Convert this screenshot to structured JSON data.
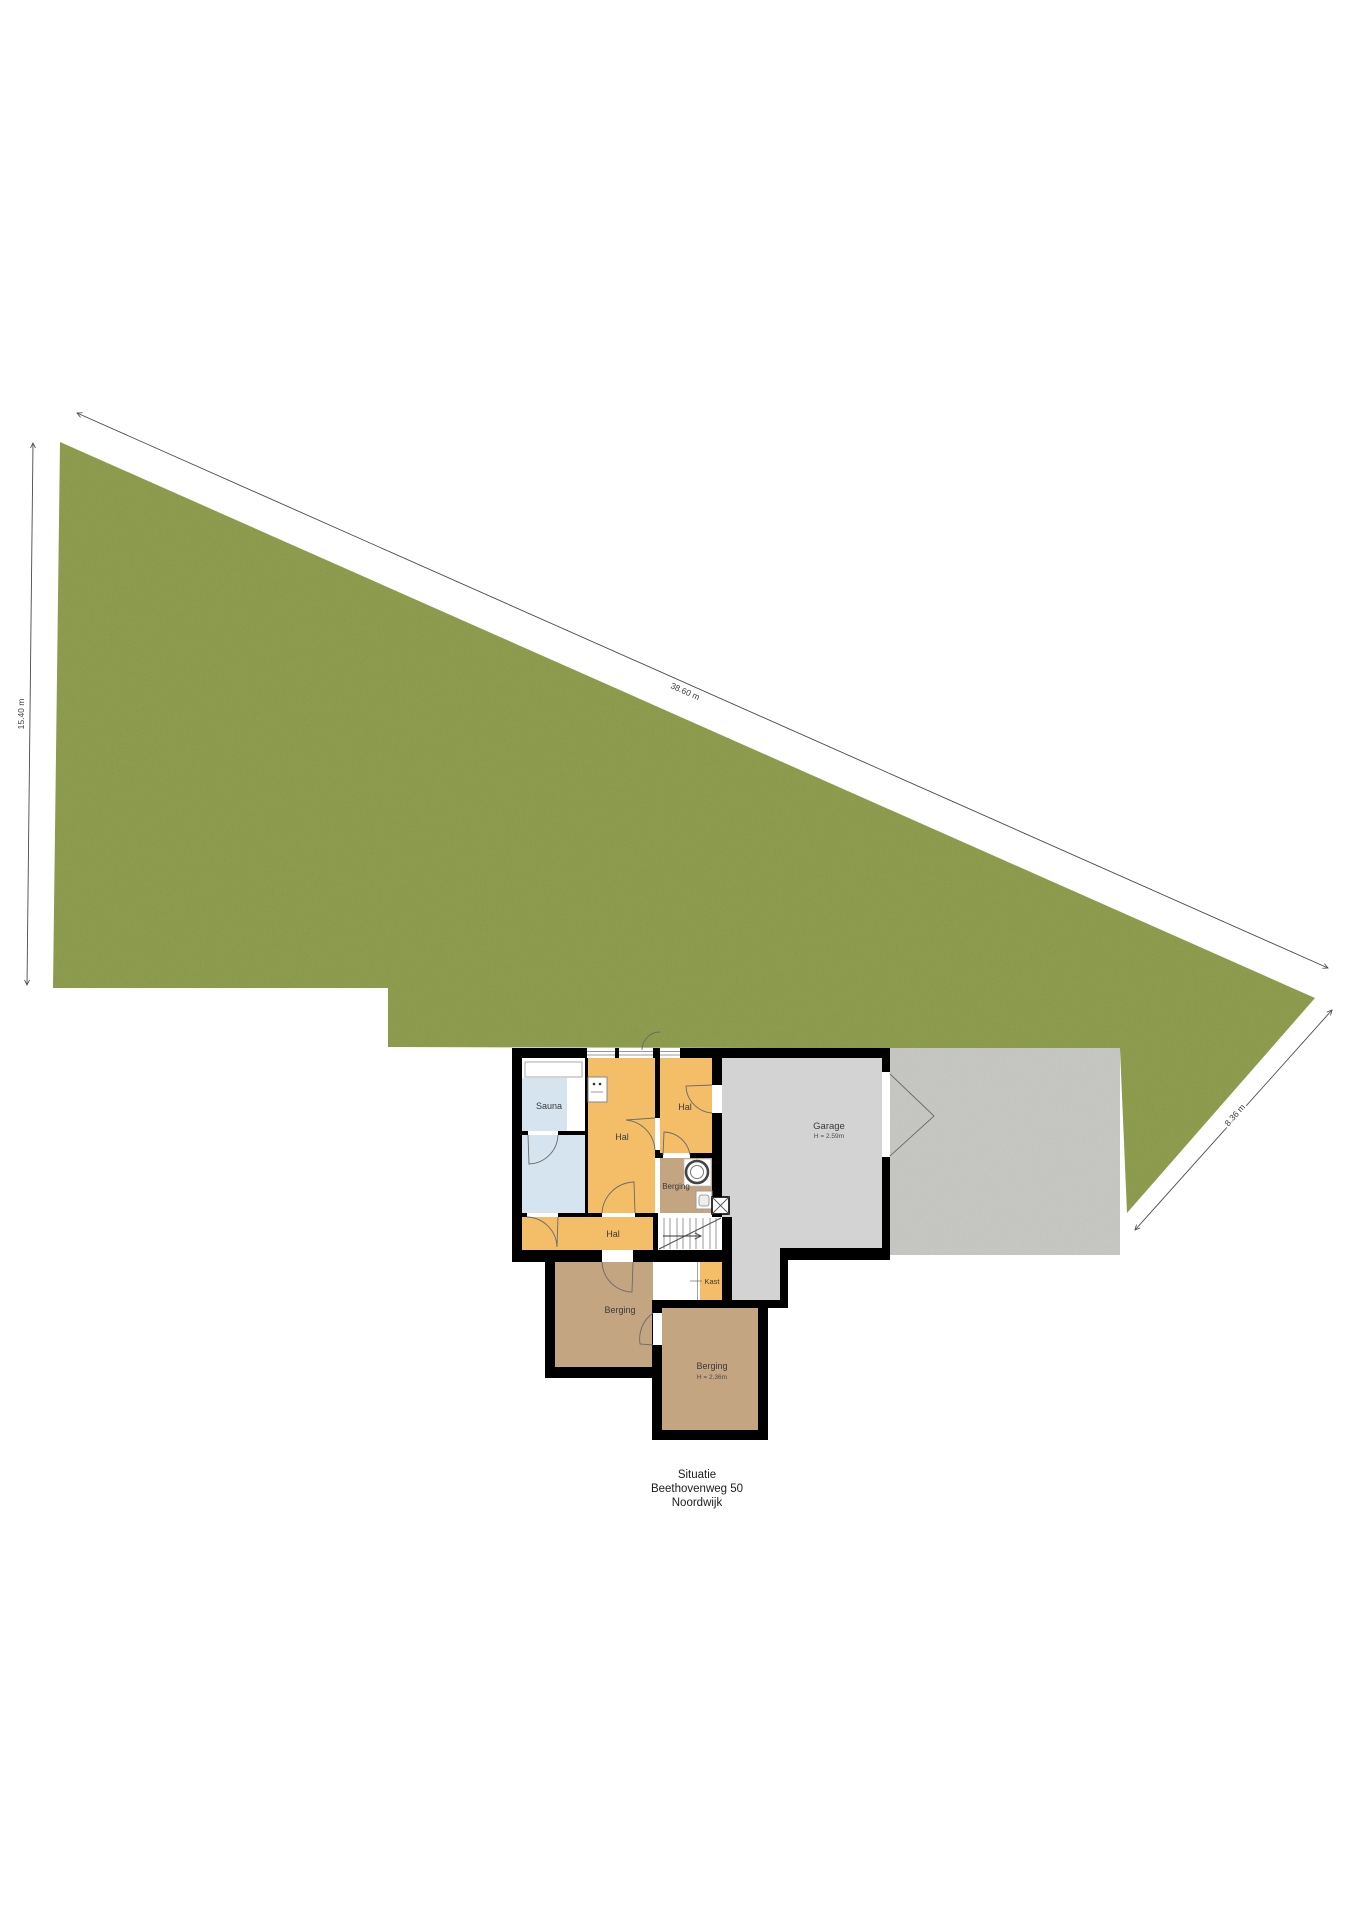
{
  "plan": {
    "title_block": {
      "line1": "Situatie",
      "line2": "Beethovenweg 50",
      "line3": "Noordwijk"
    },
    "dimensions": {
      "left_side": "15.40 m",
      "top_side": "38.60 m",
      "right_side": "8.36 m"
    },
    "rooms": {
      "sauna": "Sauna",
      "hal_main": "Hal",
      "hal_top": "Hal",
      "hal_bottom": "Hal",
      "berging_small": "Berging",
      "berging_left": "Berging",
      "berging_right": "Berging",
      "berging_right_height": "H = 2.36m",
      "kast": "Kast",
      "garage": "Garage",
      "garage_height": "H = 2.59m"
    },
    "colors": {
      "grass": "#7e963f",
      "concrete": "#cac9c5",
      "garage_floor": "#d3d3d3",
      "hall": "#f4bd68",
      "storage": "#c3a582",
      "sauna_blue": "#d5e4ee",
      "wall": "#000000",
      "dimension_line": "#4a4a4a"
    }
  }
}
